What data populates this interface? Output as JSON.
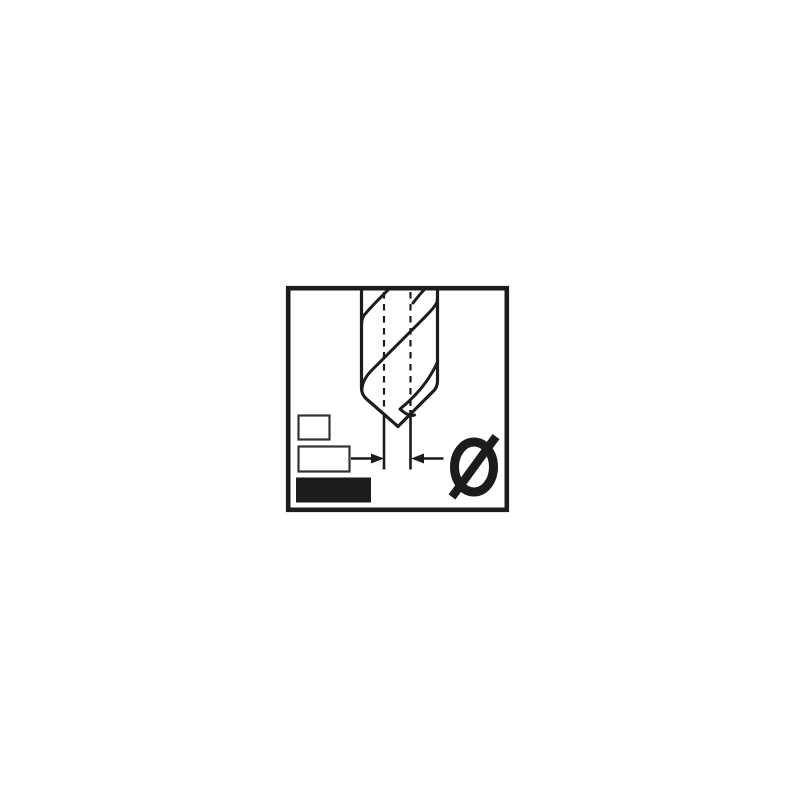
{
  "colors": {
    "canvas": "#ffffff",
    "ink": "#1c1c1a",
    "box-outline": "#323230"
  },
  "pictogram": {
    "diameter_symbol": "Ø"
  }
}
